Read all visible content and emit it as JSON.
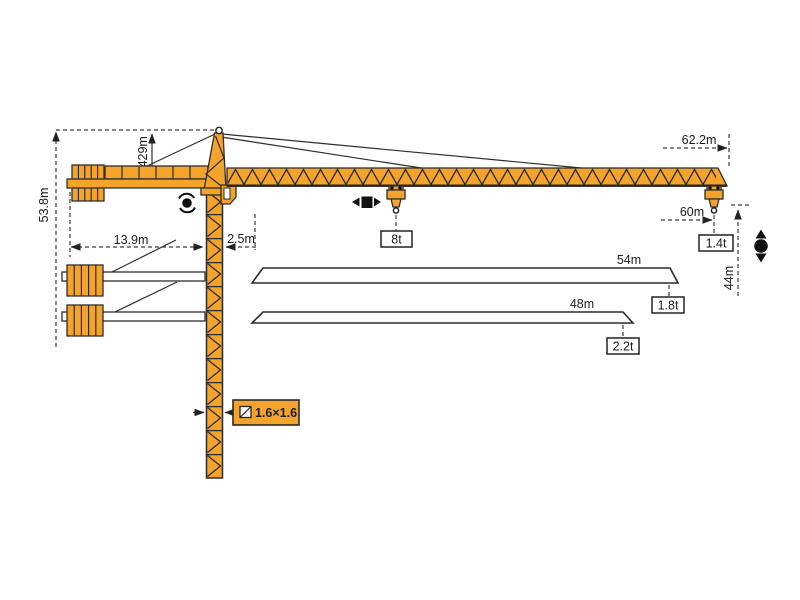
{
  "colors": {
    "crane_orange": "#F4A32B",
    "outline": "#2E2E2E",
    "dim_line": "#3A3A3A",
    "background": "#FFFFFF"
  },
  "dimensions": {
    "total_height": "53.8m",
    "tower_head_height": "7.429m",
    "counter_jib_radius": "13.9m",
    "rear_offset": "2.5m",
    "max_jib_length": "62.2m",
    "max_hook_radius": "60m",
    "hook_height": "44m",
    "mast_cross_section": "1.6×1.6"
  },
  "loads": {
    "max_load": "8t",
    "tip_load_max_jib": "1.4t"
  },
  "jib_variants": [
    {
      "length": "54m",
      "tip_load": "1.8t"
    },
    {
      "length": "48m",
      "tip_load": "2.2t"
    }
  ],
  "icons": {
    "slewing": "rotation-arrows",
    "trolley_travel": "left-right-arrows",
    "hoisting": "up-down-arrows",
    "cross_section": "section-square"
  }
}
